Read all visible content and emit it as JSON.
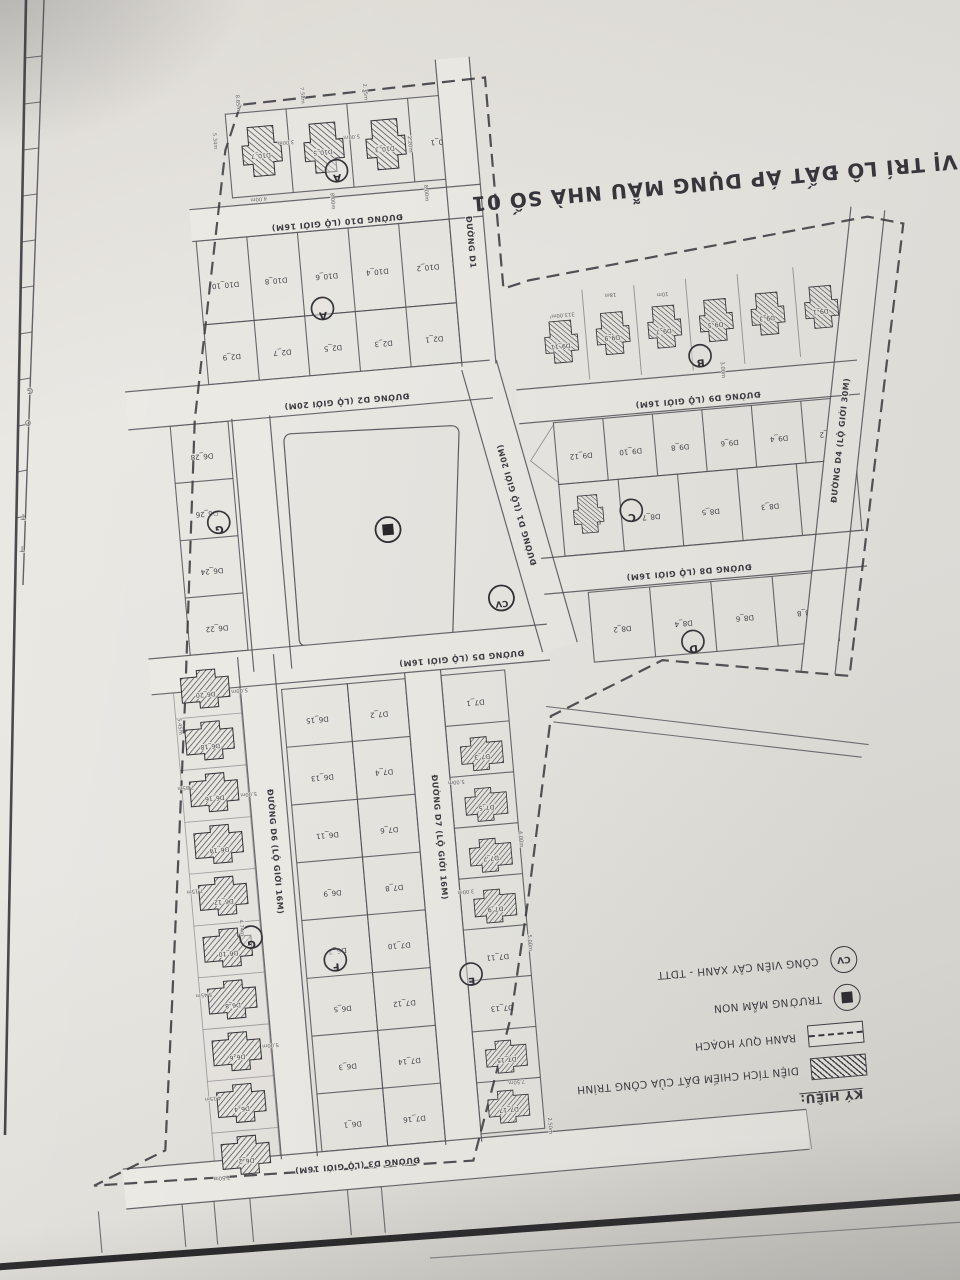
{
  "title": "VỊ TRÍ LÔ ĐẤT ÁP DỤNG MẪU NHÀ SỐ 01",
  "legend": {
    "header": "KÝ HIỆU:",
    "cv_text": "CV",
    "items": [
      {
        "icon": "hatch-swatch",
        "label": "DIỆN TÍCH CHIẾM ĐẤT CỦA CÔNG TRÌNH"
      },
      {
        "icon": "dashed-swatch",
        "label": "RANH QUY HOẠCH"
      },
      {
        "icon": "kindergarten-icon",
        "label": "TRƯỜNG MẦM NON"
      },
      {
        "icon": "park-icon",
        "label": "CÔNG VIÊN CÂY XANH - TDTT"
      }
    ]
  },
  "colors": {
    "paper": "#e8e6e1",
    "road": "#ebe9e4",
    "block": "#e7e5e0",
    "line": "#4f4f56",
    "ink": "#2e2e34",
    "hatch": "#3a3a40"
  },
  "map": {
    "tilt": -5,
    "roads": [
      {
        "id": "D10",
        "a": [
          228,
          202
        ],
        "b": [
          520,
          202
        ],
        "w": 32,
        "label": "ĐƯỜNG D10 (LỘ GIỚI 16M)",
        "lp": [
          374,
          206
        ],
        "lr": 180
      },
      {
        "id": "D2",
        "a": [
          148,
          381
        ],
        "b": [
          514,
          381
        ],
        "w": 38,
        "label": "ĐƯỜNG D2 (LỘ GIỚI 20M)",
        "lp": [
          368,
          385
        ],
        "lr": 180
      },
      {
        "id": "D9",
        "a": [
          538,
          411
        ],
        "b": [
          880,
          411
        ],
        "w": 34,
        "label": "ĐƯỜNG D9 (LỘ GIỚI 16M)",
        "lp": [
          718,
          414
        ],
        "lr": 180
      },
      {
        "id": "D8",
        "a": [
          548,
          582
        ],
        "b": [
          872,
          582
        ],
        "w": 36,
        "label": "ĐƯỜNG D8 (LỘ GIỚI 16M)",
        "lp": [
          694,
          585
        ],
        "lr": 180
      },
      {
        "id": "D5",
        "a": [
          148,
          648
        ],
        "b": [
          548,
          648
        ],
        "w": 36,
        "label": "ĐƯỜNG D5 (LỘ GIỚI 16M)",
        "lp": [
          460,
          651
        ],
        "lr": 180
      },
      {
        "id": "D3",
        "a": [
          78,
          1156
        ],
        "b": [
          764,
          1156
        ],
        "w": 40,
        "label": "ĐƯỜNG D3 (LỘ GIỚI 16M)",
        "lp": [
          312,
          1147
        ],
        "lr": 180
      },
      {
        "id": "D6n",
        "a": [
          271,
          398
        ],
        "b": [
          271,
          652
        ],
        "w": 38,
        "label": "",
        "lp": [
          0,
          0
        ],
        "lr": 0
      },
      {
        "id": "D6",
        "a": [
          255,
          636
        ],
        "b": [
          255,
          1140
        ],
        "w": 36,
        "label": "ĐƯỜNG D6 (LỘ GIỚI 16M)",
        "lp": [
          255,
          830
        ],
        "lr": 90
      },
      {
        "id": "D7",
        "a": [
          420,
          666
        ],
        "b": [
          420,
          1140
        ],
        "w": 36,
        "label": "ĐƯỜNG D7 (LỘ GIỚI 16M)",
        "lp": [
          420,
          830
        ],
        "lr": 90
      },
      {
        "id": "D1",
        "a": [
          503,
          58
        ],
        "b": [
          503,
          366
        ],
        "w": 34,
        "label": "ĐƯỜNG D1",
        "lp": [
          503,
          240
        ],
        "lr": 90
      },
      {
        "id": "D1b",
        "a": [
          503,
          366
        ],
        "b": [
          559,
          654
        ],
        "w": 36,
        "label": "ĐƯỜNG D1 (LỘ GIỚI 20M)",
        "lp": [
          531,
          505
        ],
        "lr": 259
      },
      {
        "id": "D4",
        "a": [
          904,
          244
        ],
        "b": [
          814,
          702
        ],
        "w": 34,
        "label": "ĐƯỜNG D4 (LỘ GIỚI 30M)",
        "lp": [
          859,
          470
        ],
        "lr": 281
      }
    ],
    "blocks": [
      {
        "id": "A-villas",
        "x": 272,
        "y": 94,
        "w": 244,
        "h": 84,
        "cols": 4,
        "labels": [
          "",
          "",
          "",
          "D10_1"
        ]
      },
      {
        "id": "A-row2",
        "x": 232,
        "y": 218,
        "w": 254,
        "h": 84,
        "cols": 5,
        "labels": [
          "D10_10",
          "D10_8",
          "D10_6",
          "D10_4",
          "D10_2"
        ]
      },
      {
        "id": "A-row3",
        "x": 232,
        "y": 302,
        "w": 254,
        "h": 60,
        "cols": 5,
        "labels": [
          "D2_9",
          "D2_7",
          "D2_5",
          "D2_3",
          "D2_1"
        ]
      },
      {
        "id": "C-row1",
        "x": 572,
        "y": 430,
        "w": 298,
        "h": 62,
        "cols": 6,
        "labels": [
          "D9_12",
          "D9_10",
          "D9_8",
          "D9_6",
          "D9_4",
          "D9_2"
        ]
      },
      {
        "id": "C-row2",
        "x": 572,
        "y": 492,
        "w": 298,
        "h": 72,
        "cols": 5,
        "labels": [
          "D8_9",
          "D8_7",
          "D8_5",
          "D8_3",
          "D8_1"
        ]
      },
      {
        "id": "D-row",
        "x": 592,
        "y": 602,
        "w": 246,
        "h": 70,
        "cols": 4,
        "labels": [
          "D8_2",
          "D8_4",
          "D8_6",
          "D8_8"
        ]
      },
      {
        "id": "G-col",
        "x": 190,
        "y": 400,
        "w": 58,
        "h": 230,
        "rows": 4,
        "labels": [
          "D6_28",
          "D6_26",
          "D6_24",
          "D6_22"
        ]
      },
      {
        "id": "F-left",
        "x": 278,
        "y": 672,
        "w": 66,
        "h": 464,
        "rows": 8,
        "labels": [
          "D6_15",
          "D6_13",
          "D6_11",
          "D6_9",
          "D6_7",
          "D6_5",
          "D6_3",
          "D6_1"
        ]
      },
      {
        "id": "F-right",
        "x": 344,
        "y": 672,
        "w": 58,
        "h": 464,
        "rows": 8,
        "labels": [
          "D7_2",
          "D7_4",
          "D7_6",
          "D7_8",
          "D7_10",
          "D7_12",
          "D7_14",
          "D7_16"
        ]
      },
      {
        "id": "E-col",
        "x": 438,
        "y": 672,
        "w": 64,
        "h": 460,
        "rows": 9,
        "labels": [
          "D7_1",
          "",
          "",
          "",
          "",
          "D7_11",
          "D7_13",
          "",
          ""
        ]
      },
      {
        "id": "G-strip",
        "x": 170,
        "y": 640,
        "w": 66,
        "h": 520,
        "rows": 10,
        "labels": [
          "",
          "",
          "",
          "",
          "",
          "",
          "",
          "",
          "",
          ""
        ],
        "light": true
      }
    ],
    "villas": [
      {
        "x": 304,
        "y": 134,
        "r": 90,
        "s": 0.95,
        "label": "D10_7"
      },
      {
        "x": 366,
        "y": 136,
        "r": 90,
        "s": 0.95,
        "label": "D10_5"
      },
      {
        "x": 428,
        "y": 138,
        "r": 90,
        "s": 0.95,
        "label": "D10_3"
      },
      {
        "x": 586,
        "y": 350,
        "r": 90,
        "s": 0.8,
        "label": "D9_11"
      },
      {
        "x": 638,
        "y": 346,
        "r": 90,
        "s": 0.8,
        "label": "D9_9"
      },
      {
        "x": 690,
        "y": 344,
        "r": 90,
        "s": 0.8,
        "label": "D9_7"
      },
      {
        "x": 742,
        "y": 342,
        "r": 90,
        "s": 0.8,
        "label": "D9_5"
      },
      {
        "x": 794,
        "y": 340,
        "r": 90,
        "s": 0.8,
        "label": "D9_3"
      },
      {
        "x": 848,
        "y": 338,
        "r": 90,
        "s": 0.8,
        "label": "D9_1"
      },
      {
        "x": 598,
        "y": 524,
        "r": 90,
        "s": 0.72,
        "label": ""
      },
      {
        "x": 202,
        "y": 666,
        "r": 0,
        "s": 0.92,
        "label": "D6_20"
      },
      {
        "x": 202,
        "y": 718,
        "r": 0,
        "s": 0.92,
        "label": "D6_18"
      },
      {
        "x": 202,
        "y": 770,
        "r": 0,
        "s": 0.92,
        "label": "D6_16"
      },
      {
        "x": 202,
        "y": 822,
        "r": 0,
        "s": 0.92,
        "label": "D6_14"
      },
      {
        "x": 202,
        "y": 874,
        "r": 0,
        "s": 0.92,
        "label": "D6_12"
      },
      {
        "x": 202,
        "y": 926,
        "r": 0,
        "s": 0.92,
        "label": "D6_10"
      },
      {
        "x": 202,
        "y": 978,
        "r": 0,
        "s": 0.92,
        "label": "D6_8"
      },
      {
        "x": 202,
        "y": 1030,
        "r": 0,
        "s": 0.92,
        "label": "D6_6"
      },
      {
        "x": 202,
        "y": 1082,
        "r": 0,
        "s": 0.92,
        "label": "D6_4"
      },
      {
        "x": 202,
        "y": 1134,
        "r": 0,
        "s": 0.92,
        "label": "D6_2"
      },
      {
        "x": 472,
        "y": 752,
        "r": 180,
        "s": 0.8,
        "label": "D7_3"
      },
      {
        "x": 472,
        "y": 803,
        "r": 180,
        "s": 0.8,
        "label": "D7_5"
      },
      {
        "x": 472,
        "y": 854,
        "r": 180,
        "s": 0.8,
        "label": "D7_7"
      },
      {
        "x": 472,
        "y": 905,
        "r": 180,
        "s": 0.8,
        "label": "D7_9"
      },
      {
        "x": 470,
        "y": 1056,
        "r": 180,
        "s": 0.78,
        "label": "D7_15"
      },
      {
        "x": 468,
        "y": 1106,
        "r": 180,
        "s": 0.78,
        "label": "D7_17"
      }
    ],
    "circles": [
      {
        "l": "A",
        "x": 378,
        "y": 160
      },
      {
        "l": "A",
        "x": 352,
        "y": 296
      },
      {
        "l": "B",
        "x": 724,
        "y": 376
      },
      {
        "l": "C",
        "x": 642,
        "y": 524
      },
      {
        "l": "D",
        "x": 692,
        "y": 660
      },
      {
        "l": "E",
        "x": 442,
        "y": 972
      },
      {
        "l": "F",
        "x": 308,
        "y": 946
      },
      {
        "l": "G",
        "x": 230,
        "y": 500
      },
      {
        "l": "G",
        "x": 226,
        "y": 916
      }
    ],
    "park_icon": {
      "x": 398,
      "y": 522
    },
    "cv_icon": {
      "x": 505,
      "y": 600,
      "t": "CV"
    },
    "park_path": "M310,418 Q303,418 302,425 L300,622 Q299,630 307,631 L444,642 Q452,643 453,635 L477,433 Q478,425 470,424 Z",
    "boundary": "M288,86 L269,130 L215,396 L181,674 L142,972 L122,1121 L48,1150 L428,1158 L478,1018 L506,900 L544,722 L660,676 L845,708 L938,262 L903,252 L560,286 L534,292 L534,80 Z",
    "extras": [
      {
        "d": "M540,712 L858,778"
      },
      {
        "d": "M546,728 L850,790"
      },
      {
        "d": "M612,300 L612,390",
        "l": 1
      },
      {
        "d": "M664,300 L664,390",
        "l": 1
      },
      {
        "d": "M716,298 L716,390",
        "l": 1
      },
      {
        "d": "M768,298 L768,388",
        "l": 1
      },
      {
        "d": "M824,296 L824,386",
        "l": 1
      },
      {
        "d": "M572,432 L546,466 L572,490",
        "l": 1
      },
      {
        "d": "M50,1176 L50,1300"
      },
      {
        "d": "M134,1176 L134,1300"
      },
      {
        "d": "M166,1176 L166,1250 L202,1250 L202,1176"
      },
      {
        "d": "M300,1176 L300,1254 L334,1254 L334,1176"
      },
      {
        "d": "M764,1136 L766,1176",
        "l": 1
      }
    ],
    "dims": [
      {
        "t": "8.85m",
        "x": 284,
        "y": 84,
        "r": 90
      },
      {
        "t": "7.58m",
        "x": 349,
        "y": 82,
        "r": 90
      },
      {
        "t": "2.35m",
        "x": 412,
        "y": 84,
        "r": 90
      },
      {
        "t": "5.34m",
        "x": 258,
        "y": 120,
        "r": 90
      },
      {
        "t": "3.00m",
        "x": 330,
        "y": 126,
        "r": 180
      },
      {
        "t": "4.00m",
        "x": 298,
        "y": 180,
        "r": 180
      },
      {
        "t": "8.00m",
        "x": 370,
        "y": 190,
        "r": 90
      },
      {
        "t": "5.00m",
        "x": 396,
        "y": 126,
        "r": 180
      },
      {
        "t": "2.20m",
        "x": 452,
        "y": 140,
        "r": 90
      },
      {
        "t": "8.00m",
        "x": 464,
        "y": 190,
        "r": 90
      },
      {
        "t": "313.00m²",
        "x": 590,
        "y": 322,
        "r": 180
      },
      {
        "t": "18m",
        "x": 640,
        "y": 306,
        "r": 180
      },
      {
        "t": "10m",
        "x": 692,
        "y": 310,
        "r": 180
      },
      {
        "t": "3.00m",
        "x": 744,
        "y": 392,
        "r": 90
      },
      {
        "t": "5.00m",
        "x": 236,
        "y": 668,
        "r": 180
      },
      {
        "t": "5.45m",
        "x": 172,
        "y": 700,
        "r": 90
      },
      {
        "t": "7.85m",
        "x": 174,
        "y": 760,
        "r": 180
      },
      {
        "t": "5.00m",
        "x": 236,
        "y": 772,
        "r": 180
      },
      {
        "t": "7.15m",
        "x": 174,
        "y": 864,
        "r": 180
      },
      {
        "t": "4.74m",
        "x": 216,
        "y": 906,
        "r": 90
      },
      {
        "t": "5.45m",
        "x": 174,
        "y": 968,
        "r": 180
      },
      {
        "t": "5.00m",
        "x": 236,
        "y": 1024,
        "r": 180
      },
      {
        "t": "4.15m",
        "x": 174,
        "y": 1072,
        "r": 180
      },
      {
        "t": "7.50m",
        "x": 176,
        "y": 1152,
        "r": 180
      },
      {
        "t": "5.00m",
        "x": 444,
        "y": 778,
        "r": 180
      },
      {
        "t": "4.00m",
        "x": 502,
        "y": 842,
        "r": 90
      },
      {
        "t": "3.00m",
        "x": 444,
        "y": 888,
        "r": 180
      },
      {
        "t": "5.00m",
        "x": 502,
        "y": 946,
        "r": 90
      },
      {
        "t": "7.50m",
        "x": 478,
        "y": 1082,
        "r": 180
      },
      {
        "t": "2.50m",
        "x": 506,
        "y": 1130,
        "r": 90
      }
    ]
  },
  "photo_frame": {
    "letters": [
      {
        "t": "G",
        "x": 30,
        "y": 388
      },
      {
        "t": "O",
        "x": 28,
        "y": 420
      },
      {
        "t": "T",
        "x": 23,
        "y": 514
      },
      {
        "t": "T",
        "x": 22,
        "y": 546
      }
    ]
  }
}
